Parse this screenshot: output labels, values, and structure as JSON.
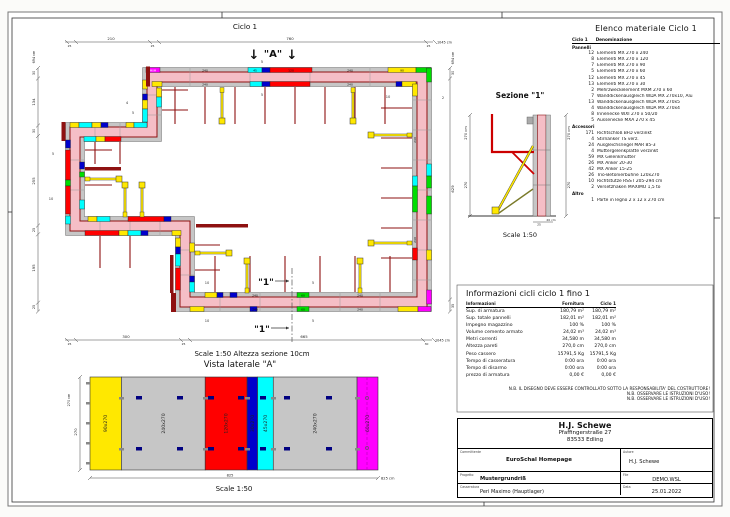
{
  "plan": {
    "title": "Ciclo 1",
    "scale_note": "Scale 1:50   Altezza sezione 10cm",
    "marker_a": {
      "label": "\"A\"",
      "sub": "5",
      "arrow": "↓"
    },
    "marker_1": {
      "label": "\"1\""
    },
    "dims": {
      "top": [
        "25",
        "210",
        "25",
        "760",
        "25",
        "1045 cm"
      ],
      "left": [
        "694 cm",
        "30",
        "134",
        "30",
        "255",
        "25",
        "195",
        "25"
      ],
      "bottom": [
        "25",
        "300",
        "25",
        "665",
        "30",
        "1045 cm"
      ],
      "right": [
        "694 cm",
        "30",
        "629",
        "35"
      ]
    },
    "labels": {
      "l240": "240",
      "l45": "45",
      "l120": "120",
      "l90": "90",
      "l60": "60",
      "lmxm": "MXM",
      "l10": "10",
      "l5": "5",
      "l4": "4",
      "l2": "2"
    }
  },
  "vista": {
    "title": "Vista laterale \"A\"",
    "scale": "Scale 1:50",
    "dims": {
      "height_total": "270 cm",
      "height": "270",
      "width_mid": "825",
      "width_total": "825 cm"
    },
    "panels": [
      {
        "label": "90x270",
        "w": 90,
        "color": "#ffe800"
      },
      {
        "label": "240x270",
        "w": 240,
        "color": "#c6c6c6"
      },
      {
        "label": "120x270",
        "w": 120,
        "color": "#ff0000"
      },
      {
        "label": "30x270",
        "w": 30,
        "color": "#0000cc"
      },
      {
        "label": "45x270",
        "w": 45,
        "color": "#00ffff"
      },
      {
        "label": "240x270",
        "w": 240,
        "color": "#c6c6c6"
      },
      {
        "label": "60x270",
        "w": 60,
        "color": "#ff00ff"
      }
    ]
  },
  "sezione": {
    "title": "Sezione \"1\"",
    "scale": "Scale 1:50",
    "left_total": "270 cm",
    "left_seg": "270",
    "right_total": "270 cm",
    "right_seg": "270",
    "bottom_a": "25",
    "bottom_b": "20 cm"
  },
  "materiale": {
    "title": "Elenco materiale  Ciclo 1",
    "col_qty": "Ciclo 1",
    "col_name": "Denominazione",
    "groups": [
      {
        "name": "Pannelli",
        "items": [
          {
            "qty": "12",
            "name": "Elementi MX 270 x 240"
          },
          {
            "qty": "8",
            "name": "Elementi MX 270 x 120"
          },
          {
            "qty": "7",
            "name": "Elementi MX 270 x 90"
          },
          {
            "qty": "5",
            "name": "Elementi MX 270 x 60"
          },
          {
            "qty": "12",
            "name": "Elementi MX 270 x 45"
          },
          {
            "qty": "13",
            "name": "Elementi MX 270 x 30"
          },
          {
            "qty": "2",
            "name": "Mehrzweckelement MXM 270 x 60"
          },
          {
            "qty": "7",
            "name": "Wanddickenausgleich WDA MX 270x10, Alu"
          },
          {
            "qty": "13",
            "name": "Wanddickenausgleich WDA MX 270x5"
          },
          {
            "qty": "4",
            "name": "Wanddickenausgleich WDA MX 270x4"
          },
          {
            "qty": "8",
            "name": "Innenecke WXI 270 x 50/20"
          },
          {
            "qty": "5",
            "name": "Aussenecke MXA 270 x 45"
          }
        ]
      },
      {
        "name": "Accessori",
        "items": [
          {
            "qty": "171",
            "name": "Richtschloß BFD verzinkt"
          },
          {
            "qty": "4",
            "name": "Stirnanker TS verz."
          },
          {
            "qty": "24",
            "name": "Ausgleichsriegel MAR 85-3"
          },
          {
            "qty": "4",
            "name": "Muttergelenkplatte verzinkt"
          },
          {
            "qty": "59",
            "name": "MX Gelenkmutter"
          },
          {
            "qty": "26",
            "name": "MX Anker 20-30"
          },
          {
            "qty": "42",
            "name": "MX Anker 15-25"
          },
          {
            "qty": "26",
            "name": "Trio-Betonierbühne 120x270"
          },
          {
            "qty": "10",
            "name": "Richtstütze RSS I  205-294 cm"
          },
          {
            "qty": "2",
            "name": "Versetzhaken MAXIMO 1,5 to"
          }
        ]
      },
      {
        "name": "Altro",
        "items": [
          {
            "qty": "1",
            "name": "Parte in legno 2 x 12 x 270 cm"
          }
        ]
      }
    ]
  },
  "info": {
    "title": "Informazioni cicli  ciclo 1 fino 1",
    "cols": [
      "Informazioni",
      "Fornitura",
      "Ciclo 1"
    ],
    "rows": [
      {
        "label": "Sup. di armatura",
        "fornitura": "180,79 m²",
        "ciclo": "180,79 m²"
      },
      {
        "label": "Sup. totale pannelli",
        "fornitura": "182,01 m²",
        "ciclo": "182,01 m²"
      },
      {
        "label": "Impegno magazzino",
        "fornitura": "100 %",
        "ciclo": "100 %"
      },
      {
        "label": "Volume cemento armato",
        "fornitura": "24,02 m³",
        "ciclo": "24,02 m³"
      },
      {
        "label": "Metri correnti",
        "fornitura": "34,580 m",
        "ciclo": "34,580 m"
      },
      {
        "label": "Altezza pareti",
        "fornitura": "270,0 cm",
        "ciclo": "270,0 cm"
      },
      {
        "label": "Peso cassero",
        "fornitura": "15791,5 Kg",
        "ciclo": "15791,5 Kg"
      },
      {
        "label": "Tempo di casseratura",
        "fornitura": "0:00 ora",
        "ciclo": "0:00 ora"
      },
      {
        "label": "Tempo di disarmo",
        "fornitura": "0:00 ora",
        "ciclo": "0:00 ora"
      },
      {
        "label": "prezzo di armatura",
        "fornitura": "0,00 €",
        "ciclo": "0,00 €"
      }
    ]
  },
  "notes": [
    "N.B. IL DISEGNO DEVE ESSERE CONTROLLATO SOTTO LA RESPONSABILITA' DEL COSTRUTTORE!",
    "N.B. OSSERVARE LE ISTRUZIONI D'USO!",
    "N.B. OSSERVARE LE ISTRUZIONI D'USO!"
  ],
  "titleblock": {
    "company": "H.J. Schewe",
    "address1": "Pfaffingerstraße 27",
    "address2": "83533 Edling",
    "committente_label": "Committente",
    "committente": "EuroSchal Homepage",
    "autore_label": "Autore",
    "autore": "H.J. Schewe",
    "progetto_label": "Progetto",
    "progetto": "Mustergrundriß",
    "file_label": "File",
    "file": "DEMO.WSL",
    "casseratura_label": "Casseratura",
    "casseratura": "Peri Maximo (Hauptlager)",
    "data_label": "Data",
    "data": "25.01.2022"
  },
  "colors": {
    "wall": "#f5bec6",
    "band": "#c6c6c6",
    "panel_red": "#8e1111",
    "accent_yellow": "#ffe800"
  }
}
